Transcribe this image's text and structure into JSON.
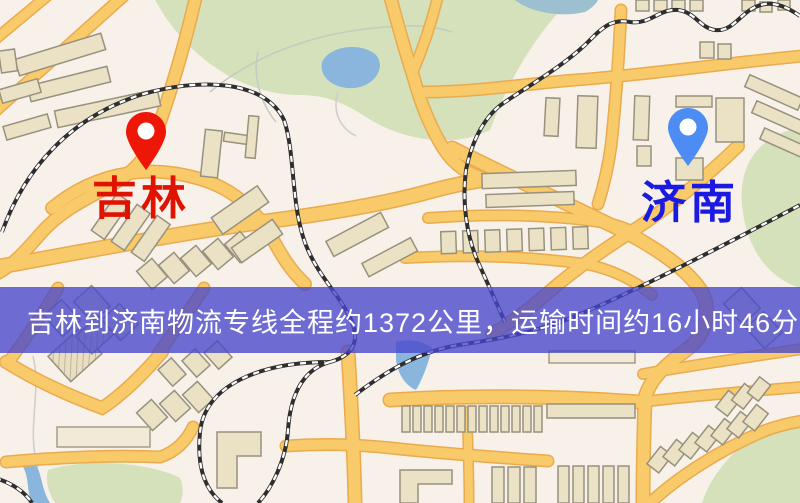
{
  "banner": {
    "text": "吉林到济南物流专线全程约1372公里，运输时间约16小时46分钟.",
    "bg_color": "#4646cc",
    "text_color": "#ffffff"
  },
  "markers": {
    "origin": {
      "label": "吉林",
      "pin_color": "#ed1607",
      "label_color": "#e01200"
    },
    "destination": {
      "label": "济南",
      "pin_color": "#4d8cf2",
      "label_color": "#1a1ae0"
    }
  },
  "map": {
    "colors": {
      "background": "#f8f1ea",
      "road_fill": "#f8ca6a",
      "road_casing": "#e9ab4e",
      "building_fill": "#ebe1c4",
      "building_outline": "#97917e",
      "park": "#d4e1bb",
      "water": "#8ab6de",
      "railway_dark": "#2e2e2e",
      "railway_light": "#ffffff"
    }
  }
}
